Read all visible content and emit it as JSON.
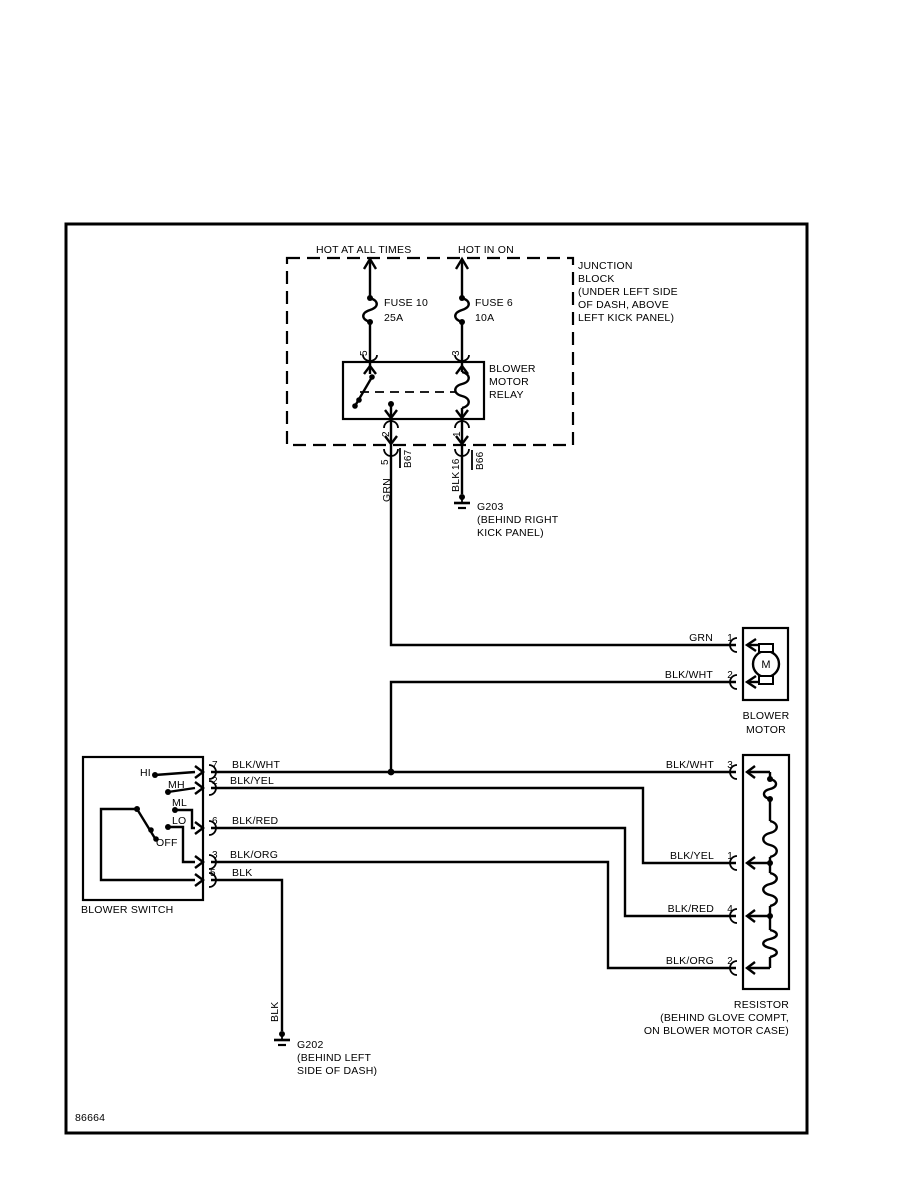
{
  "colors": {
    "ink": "#000000",
    "paper": "#ffffff"
  },
  "footer": {
    "figure_number": "86664"
  },
  "power": {
    "hot_at_all_times": "HOT AT ALL TIMES",
    "hot_in_on": "HOT IN ON"
  },
  "junction_block": {
    "lines": [
      "JUNCTION",
      "BLOCK",
      "(UNDER LEFT SIDE",
      "OF DASH, ABOVE",
      "LEFT KICK PANEL)"
    ]
  },
  "fuse10": {
    "name": "FUSE 10",
    "rating": "25A",
    "pin": "5"
  },
  "fuse6": {
    "name": "FUSE 6",
    "rating": "10A",
    "pin": "3"
  },
  "relay": {
    "lines": [
      "BLOWER",
      "MOTOR",
      "RELAY"
    ],
    "pin_out_left": "2",
    "pin_out_right": "1"
  },
  "connector_b67": {
    "pin": "5",
    "name": "B67"
  },
  "connector_b66": {
    "pin": "16",
    "name": "B66"
  },
  "wire_labels": {
    "grn_vertical": "GRN",
    "blk_g203": "BLK",
    "blk_g202": "BLK"
  },
  "ground_g203": {
    "name": "G203",
    "lines": [
      "(BEHIND RIGHT",
      "KICK PANEL)"
    ]
  },
  "ground_g202": {
    "name": "G202",
    "lines": [
      "(BEHIND LEFT",
      "SIDE OF DASH)"
    ]
  },
  "motor": {
    "pin1": "1",
    "wire1": "GRN",
    "pin2": "2",
    "wire2": "BLK/WHT",
    "symbol": "M",
    "lines": [
      "BLOWER",
      "MOTOR"
    ]
  },
  "blower_switch": {
    "label": "BLOWER SWITCH",
    "positions": {
      "hi": "HI",
      "mh": "MH",
      "ml": "ML",
      "lo": "LO",
      "off": "OFF"
    },
    "rows": [
      {
        "pin": "7",
        "wire": "BLK/WHT"
      },
      {
        "pin": "2",
        "wire": "BLK/YEL"
      },
      {
        "pin": "6",
        "wire": "BLK/RED"
      },
      {
        "pin": "3",
        "wire": "BLK/ORG"
      },
      {
        "pin": "5",
        "wire": "BLK"
      }
    ]
  },
  "resistor": {
    "lines": [
      "RESISTOR",
      "(BEHIND GLOVE COMPT,",
      "ON BLOWER MOTOR CASE)"
    ],
    "rows": [
      {
        "pin": "3",
        "wire": "BLK/WHT"
      },
      {
        "pin": "1",
        "wire": "BLK/YEL"
      },
      {
        "pin": "4",
        "wire": "BLK/RED"
      },
      {
        "pin": "2",
        "wire": "BLK/ORG"
      }
    ]
  }
}
